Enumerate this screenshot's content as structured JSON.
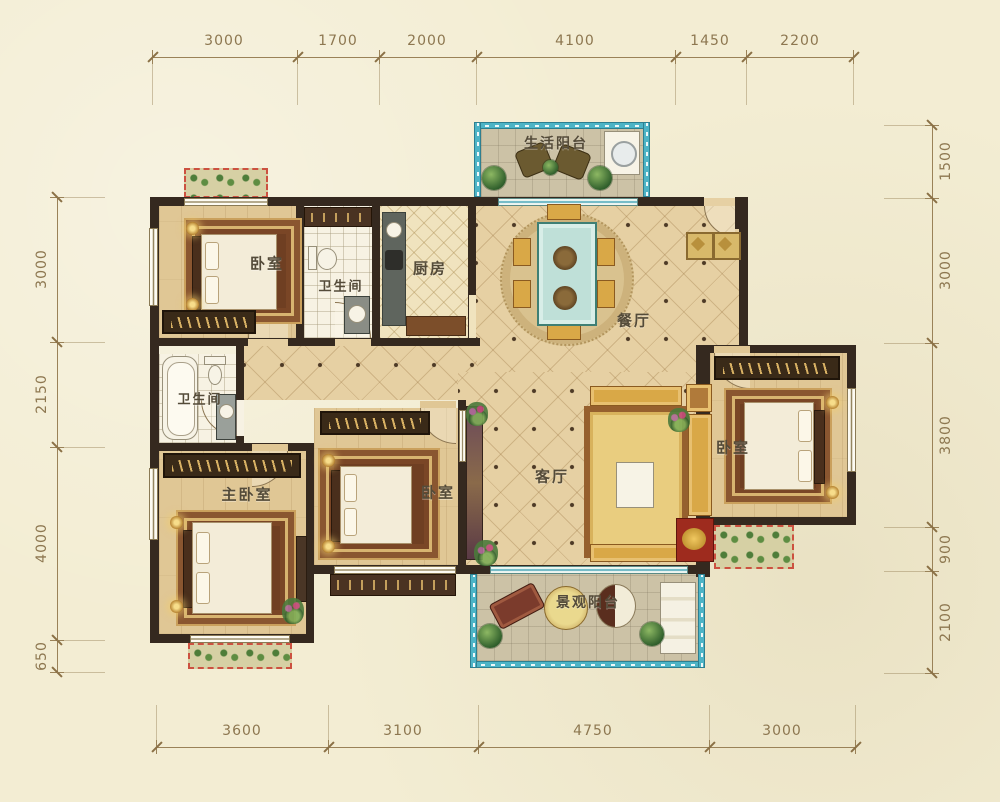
{
  "dims": {
    "top": [
      "3000",
      "1700",
      "2000",
      "4100",
      "1450",
      "2200"
    ],
    "bottom": [
      "3600",
      "3100",
      "4750",
      "3000"
    ],
    "left": [
      "3000",
      "2150",
      "4000",
      "650"
    ],
    "right": [
      "1500",
      "3000",
      "3800",
      "900",
      "2100"
    ]
  },
  "rooms": {
    "bedroom_top_left": "卧室",
    "bathroom_top": "卫生间",
    "kitchen": "厨房",
    "service_balcony": "生活阳台",
    "dining_room": "餐厅",
    "living_room": "客厅",
    "bathroom_left": "卫生间",
    "master_bedroom": "主卧室",
    "bedroom_middle": "卧室",
    "bedroom_right": "卧室",
    "view_balcony": "景观阳台"
  },
  "colors": {
    "background": "#f3edd3",
    "wall": "#35291f",
    "dimension_line": "#9a8258",
    "balcony_window": "#4db4c6",
    "wood_floor": "#e0c795",
    "tile_floor": "#e6d0a3",
    "label_text": "#544b39",
    "flower_box_border": "#cc5140"
  }
}
